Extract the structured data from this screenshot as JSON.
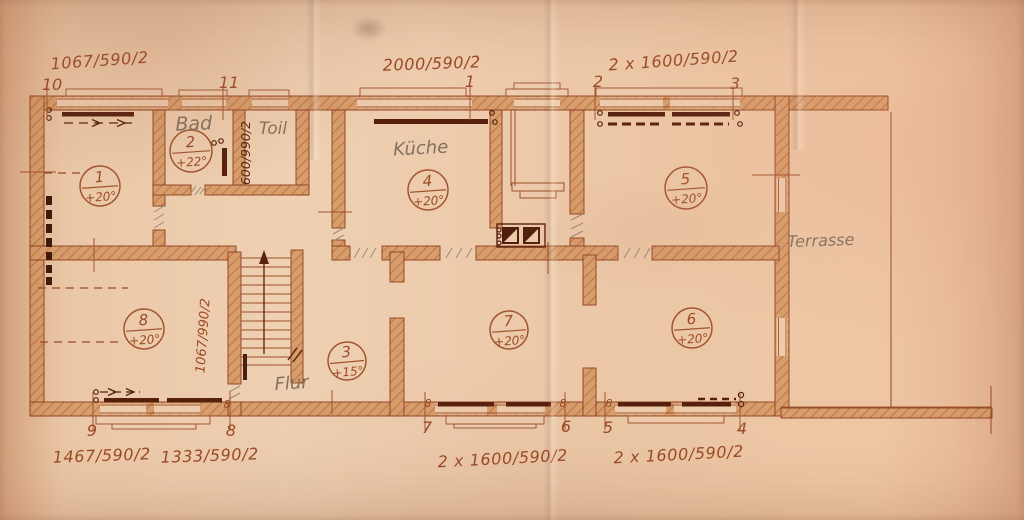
{
  "document": {
    "kind": "scanned floor plan drawing"
  },
  "colors": {
    "paper": "#ecc9a9",
    "ink": "#9c4a26",
    "ink_dark": "#5a230f",
    "pencil": "#84715f",
    "wall_fill": "#d69d6d"
  },
  "dimensions": {
    "top_left": "1067/590/2",
    "top_center": "2000/590/2",
    "top_right": "2 x 1600/590/2",
    "bottom_left": "1467/590/2",
    "bottom_left2": "1333/590/2",
    "bottom_center": "2 x 1600/590/2",
    "bottom_right": "2 x 1600/590/2",
    "toilet_window_vertical": "600/990/2",
    "stair_wall_vertical": "1067/990/2"
  },
  "position_markers": {
    "top": {
      "p10": "10",
      "p11": "11",
      "p1": "1",
      "p2": "2",
      "p3": "3"
    },
    "bottom": {
      "p9": "9",
      "p8": "8",
      "p7": "7",
      "p6": "6",
      "p5": "5",
      "p4": "4"
    }
  },
  "rooms": {
    "room1": {
      "number": "1",
      "temperature": "+20°"
    },
    "room2": {
      "number": "2",
      "temperature": "+22°",
      "name": "Bad"
    },
    "room3": {
      "number": "3",
      "temperature": "+15°",
      "name": "Flur"
    },
    "room4": {
      "number": "4",
      "temperature": "+20°",
      "name": "Küche"
    },
    "room5": {
      "number": "5",
      "temperature": "+20°"
    },
    "room6": {
      "number": "6",
      "temperature": "+20°"
    },
    "room7": {
      "number": "7",
      "temperature": "+20°"
    },
    "room8": {
      "number": "8",
      "temperature": "+20°"
    },
    "toilet_name": "Toil",
    "terrace_name": "Terrasse"
  },
  "radiator_tag": "8"
}
